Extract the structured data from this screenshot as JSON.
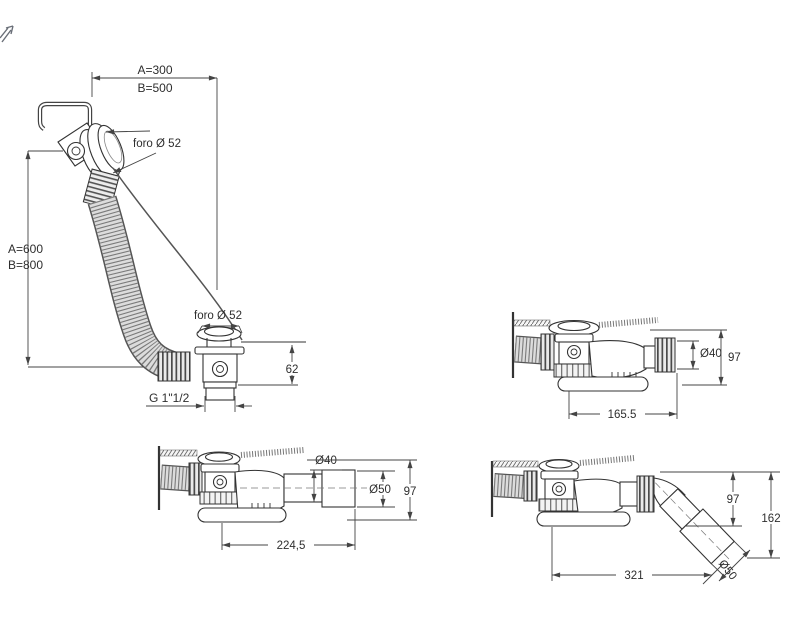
{
  "pointer": {
    "icon": "cursor-arrow"
  },
  "views": {
    "overflow": {
      "dim_width_a": "A=300",
      "dim_width_b": "B=500",
      "overflow_hole_label": "foro Ø 52",
      "dim_height_a": "A=600",
      "dim_height_b": "B=800",
      "drain_hole_label": "foro Ø 52",
      "dim_body_height": "62",
      "thread_label": "G 1\"1/2"
    },
    "outlet_straight": {
      "outlet_diameter": "Ø40",
      "height": "97",
      "length": "165.5"
    },
    "outlet_extension": {
      "outlet_diameter": "Ø40",
      "end_diameter": "Ø50",
      "height": "97",
      "length": "224,5"
    },
    "outlet_angled": {
      "height": "97",
      "total_height": "162",
      "length": "321",
      "end_diameter": "Ø50"
    }
  }
}
